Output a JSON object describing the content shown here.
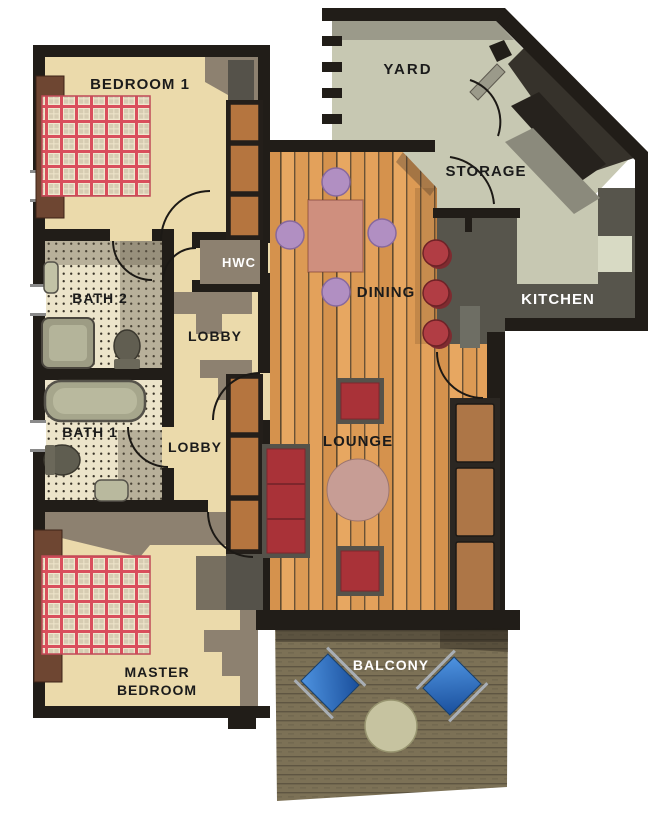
{
  "plan": {
    "type": "apartment-floor-plan",
    "palette": {
      "wall": "#211d18",
      "floor_cream": "#ebdaab",
      "shadow_taupe": "#8d8170",
      "wood": "#e2a35f",
      "sage": "#c7c8b2",
      "kitchen_dark": "#57554c",
      "deck": "#7c7156",
      "plaid_red": "#d94f5c",
      "chair_purple": "#b18fc2",
      "sofa_red": "#a93238",
      "stool_red": "#b13d44",
      "cabinet_brown": "#b5753f",
      "sofa_brown": "#ad7647",
      "balcony_blue": "#2f6fc4",
      "balcony_table": "#c6c3a0"
    },
    "rooms": {
      "bedroom1": {
        "label": "BEDROOM 1"
      },
      "yard": {
        "label": "YARD"
      },
      "storage": {
        "label": "STORAGE"
      },
      "hwc": {
        "label": "HWC"
      },
      "bath2": {
        "label": "BATH 2"
      },
      "lobby_upper": {
        "label": "LOBBY"
      },
      "bath1": {
        "label": "BATH 1"
      },
      "lobby_lower": {
        "label": "LOBBY"
      },
      "dining": {
        "label": "DINING"
      },
      "kitchen": {
        "label": "KITCHEN"
      },
      "lounge": {
        "label": "LOUNGE"
      },
      "master_bedroom": {
        "label_line1": "MASTER",
        "label_line2": "BEDROOM"
      },
      "balcony": {
        "label": "BALCONY"
      }
    }
  }
}
